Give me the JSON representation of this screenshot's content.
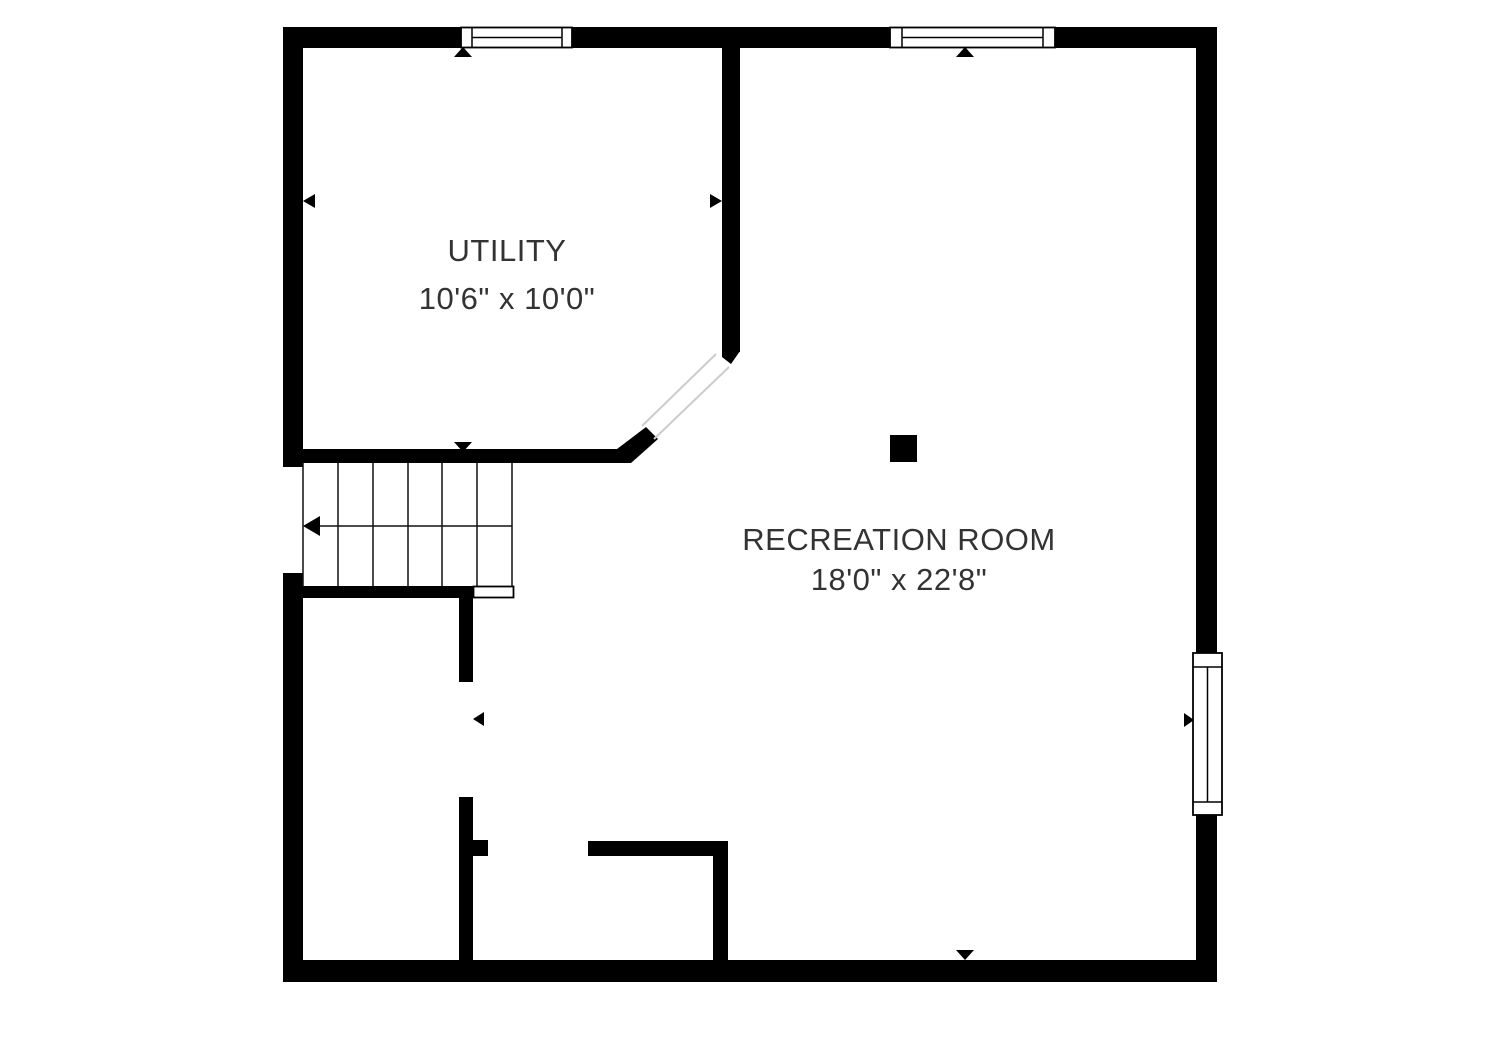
{
  "colors": {
    "background": "#ffffff",
    "walls": "#000000",
    "text": "#333333",
    "opening_lines": "#cccccc"
  },
  "rooms": [
    {
      "id": "utility",
      "name": "UTILITY",
      "dimensions": "10'6\" x 10'0\""
    },
    {
      "id": "recreation-room",
      "name": "RECREATION ROOM",
      "dimensions": "18'0\" x 22'8\""
    }
  ],
  "features": {
    "windows": [
      {
        "id": "top-left-window",
        "wall": "top"
      },
      {
        "id": "top-right-window",
        "wall": "top"
      },
      {
        "id": "right-wall-window",
        "wall": "right"
      }
    ],
    "stairs": {
      "tread_count": 6,
      "direction_arrow": "left"
    },
    "support_column": "black-square-column",
    "door_openings": [
      "diagonal-opening-utility-to-recreation",
      "opening-lower-left-hall",
      "opening-bottom-center",
      "left-wall-stair-opening"
    ]
  }
}
